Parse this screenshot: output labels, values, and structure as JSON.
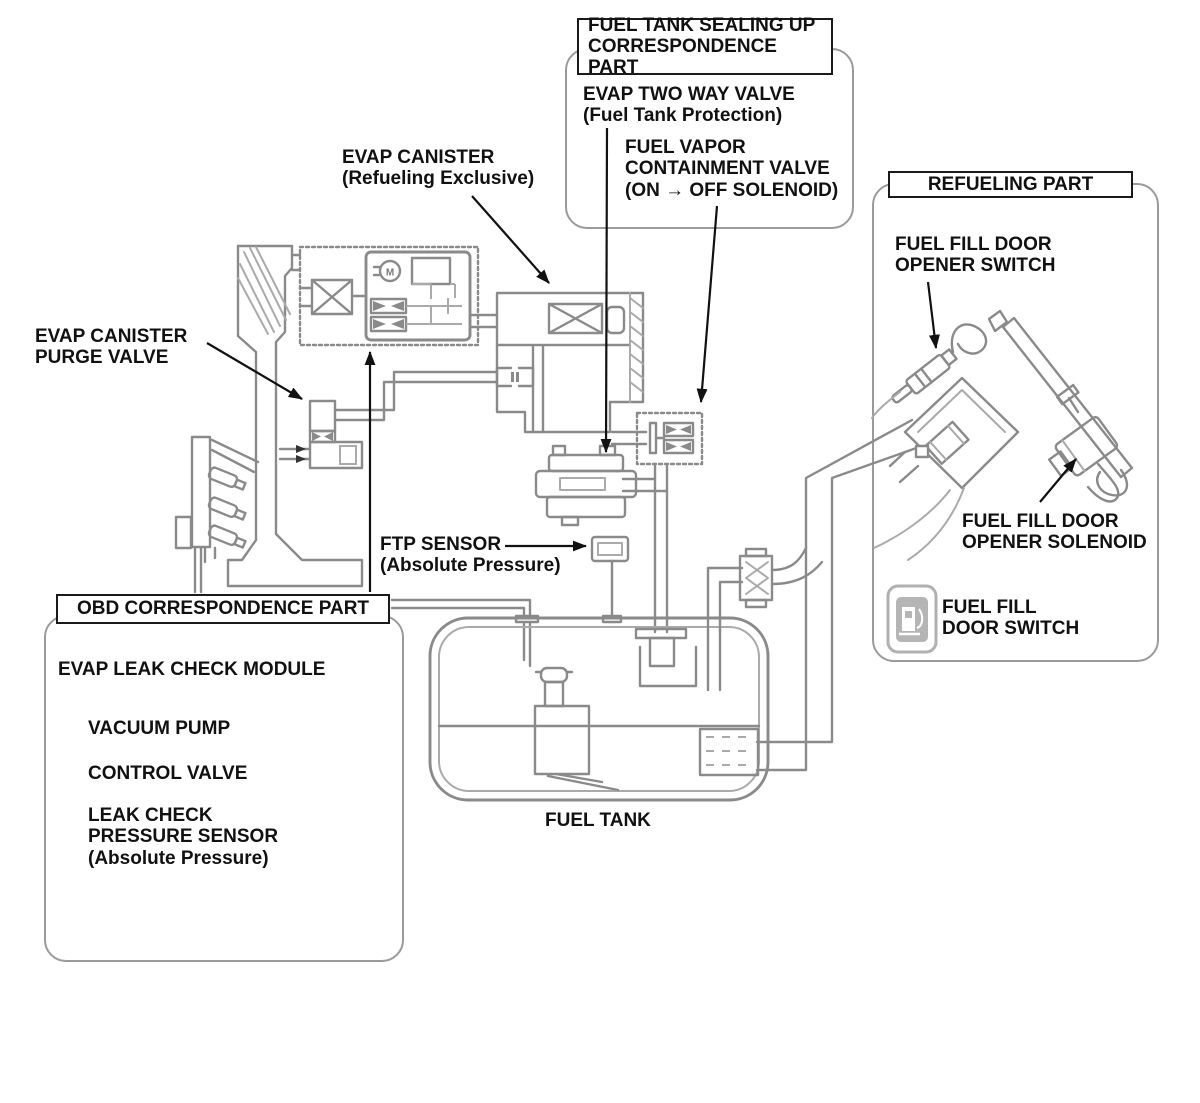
{
  "diagram": {
    "title_boxes": {
      "sealing": "FUEL TANK SEALING UP\nCORRESPONDENCE PART",
      "refueling": "REFUELING PART",
      "obd": "OBD CORRESPONDENCE PART"
    },
    "labels": {
      "evap_two_way_valve": "EVAP TWO WAY VALVE\n(Fuel Tank Protection)",
      "fuel_vapor_containment_valve": "FUEL VAPOR\nCONTAINMENT VALVE\n(ON → OFF SOLENOID)",
      "evap_canister": "EVAP CANISTER\n(Refueling Exclusive)",
      "evap_canister_purge_valve": "EVAP CANISTER\nPURGE VALVE",
      "fuel_fill_door_opener_switch": "FUEL FILL DOOR\nOPENER SWITCH",
      "fuel_fill_door_opener_solenoid": "FUEL FILL DOOR\nOPENER SOLENOID",
      "ftp_sensor": "FTP SENSOR\n(Absolute Pressure)",
      "evap_leak_check_module": "EVAP LEAK CHECK MODULE",
      "vacuum_pump": "VACUUM PUMP",
      "control_valve": "CONTROL VALVE",
      "leak_check_pressure_sensor": "LEAK CHECK\nPRESSURE SENSOR\n(Absolute Pressure)",
      "fuel_fill_door_switch": "FUEL FILL\nDOOR SWITCH",
      "fuel_tank": "FUEL TANK",
      "motor": "M"
    },
    "icons": {
      "fuel_fill_door_switch_icon": "fuel-pump-icon"
    },
    "colors": {
      "line": "#8a8a8a",
      "label": "#111111",
      "container_border": "#9a9a9a",
      "icon_gray": "#b5b5b5",
      "background": "#ffffff"
    }
  }
}
